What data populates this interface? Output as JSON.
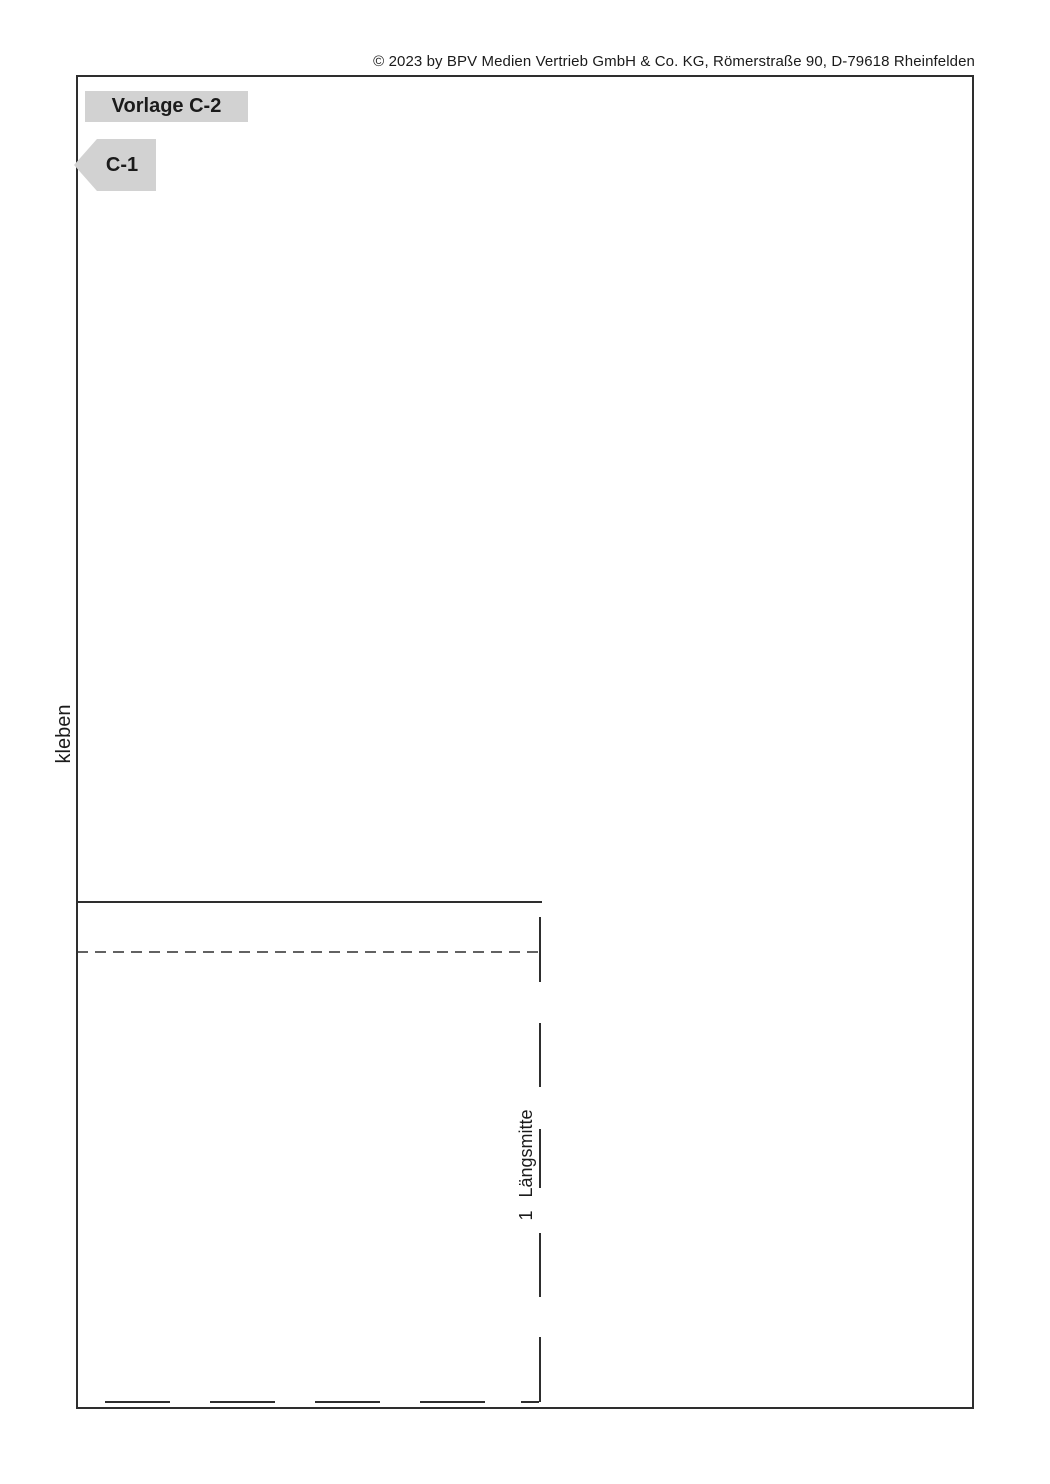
{
  "page": {
    "copyright": "© 2023 by BPV Medien Vertrieb GmbH & Co. KG, Römerstraße 90, D-79618 Rheinfelden"
  },
  "header": {
    "template_title": "Vorlage C-2",
    "piece_label": "C-1"
  },
  "labels": {
    "glue": "kleben",
    "fold_number": "1",
    "fold_label": "Längsmitte"
  },
  "colors": {
    "badge_gray": "#d2d2d2",
    "line_color": "#2e2e2e",
    "text_color": "#1b1b1b",
    "background": "#ffffff"
  }
}
